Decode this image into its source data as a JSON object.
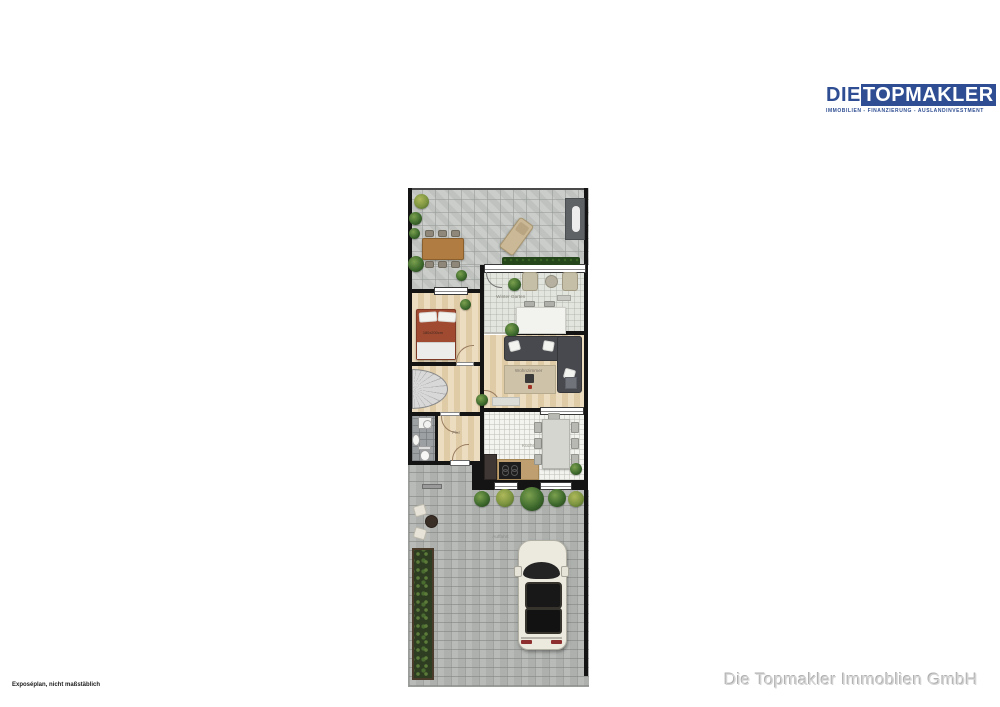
{
  "logo": {
    "die": "DIE",
    "topmakler": "TOPMAKLER",
    "subtitle": "IMMOBILIEN - FINANZIERUNG - AUSLANDINVESTMENT",
    "brand_blue": "#2e4d92"
  },
  "floorplan": {
    "rooms": {
      "winter_garten": "Winter Garten",
      "wohnzimmer": "Wohnzimmer",
      "kueche": "Küche",
      "flur": "Flur",
      "auffahrt": "Auffahrt"
    },
    "bed_label": "180x200cm",
    "colors": {
      "bed_red": "#a04a31",
      "sofa_gray": "#47494e",
      "hedge_green": "#24461a",
      "car_cream": "#eceadf",
      "terrace_paver": "#c7cac6",
      "driveway_paver": "#b4b7b4",
      "wall_black": "#141414"
    }
  },
  "footer": {
    "left_note": "Exposéplan, nicht maßstäblich",
    "right_company": "Die Topmakler Immoblien GmbH"
  }
}
